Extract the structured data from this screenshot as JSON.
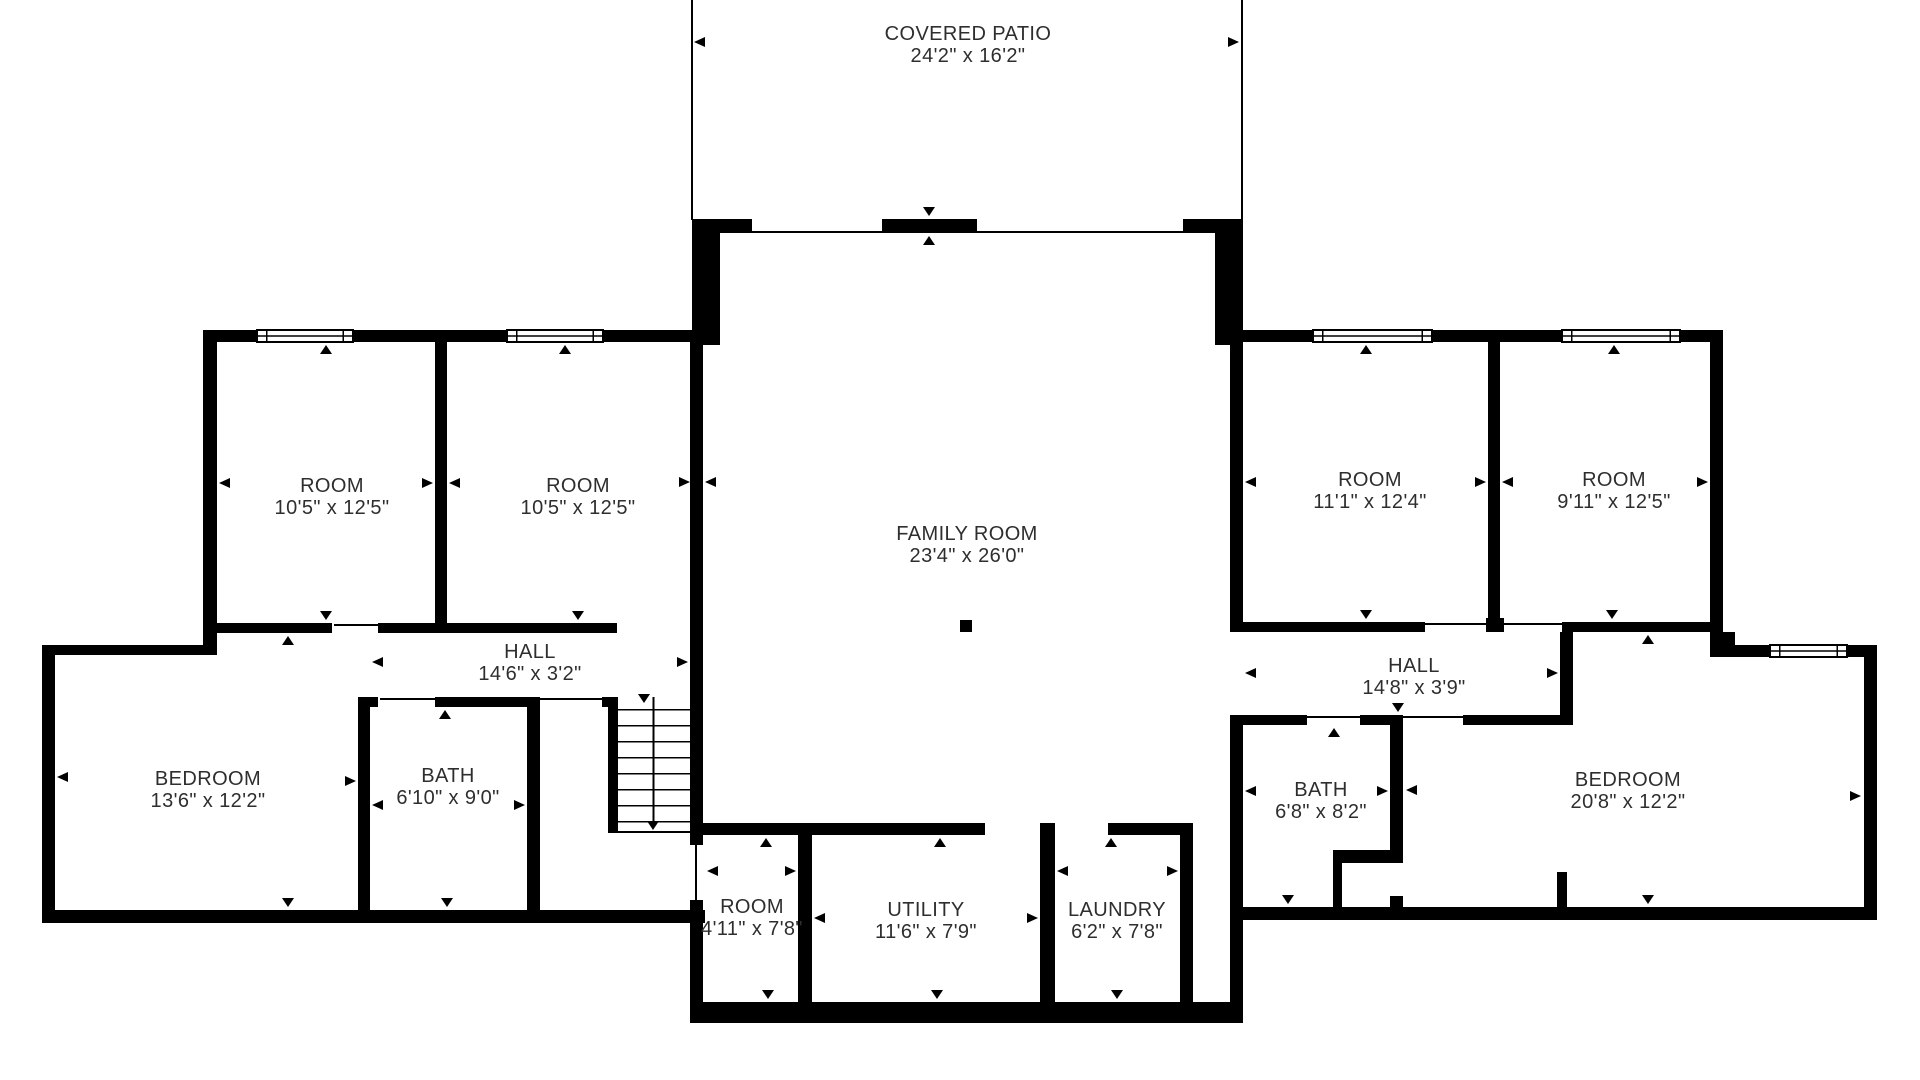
{
  "plan": {
    "type": "floor-plan",
    "colors": {
      "wall": "#000000",
      "text": "#2e2e2e",
      "background": "#ffffff"
    },
    "rooms": [
      {
        "id": "covered-patio",
        "name": "COVERED PATIO",
        "dims": "24'2\" x 16'2\"",
        "cx": 968,
        "cy": 45
      },
      {
        "id": "room-left-1",
        "name": "ROOM",
        "dims": "10'5\" x 12'5\"",
        "cx": 332,
        "cy": 497
      },
      {
        "id": "room-left-2",
        "name": "ROOM",
        "dims": "10'5\" x 12'5\"",
        "cx": 578,
        "cy": 497
      },
      {
        "id": "family-room",
        "name": "FAMILY ROOM",
        "dims": "23'4\" x 26'0\"",
        "cx": 967,
        "cy": 545
      },
      {
        "id": "room-right-1",
        "name": "ROOM",
        "dims": "11'1\" x 12'4\"",
        "cx": 1370,
        "cy": 491
      },
      {
        "id": "room-right-2",
        "name": "ROOM",
        "dims": "9'11\" x 12'5\"",
        "cx": 1614,
        "cy": 491
      },
      {
        "id": "hall-left",
        "name": "HALL",
        "dims": "14'6\" x 3'2\"",
        "cx": 530,
        "cy": 663
      },
      {
        "id": "hall-right",
        "name": "HALL",
        "dims": "14'8\" x 3'9\"",
        "cx": 1414,
        "cy": 677
      },
      {
        "id": "bedroom-left",
        "name": "BEDROOM",
        "dims": "13'6\" x 12'2\"",
        "cx": 208,
        "cy": 790
      },
      {
        "id": "bath-left",
        "name": "BATH",
        "dims": "6'10\" x 9'0\"",
        "cx": 448,
        "cy": 787
      },
      {
        "id": "bath-right",
        "name": "BATH",
        "dims": "6'8\" x 8'2\"",
        "cx": 1321,
        "cy": 801
      },
      {
        "id": "bedroom-right",
        "name": "BEDROOM",
        "dims": "20'8\" x 12'2\"",
        "cx": 1628,
        "cy": 791
      },
      {
        "id": "room-small",
        "name": "ROOM",
        "dims": "4'11\" x 7'8\"",
        "cx": 752,
        "cy": 918
      },
      {
        "id": "utility",
        "name": "UTILITY",
        "dims": "11'6\" x 7'9\"",
        "cx": 926,
        "cy": 921
      },
      {
        "id": "laundry",
        "name": "LAUNDRY",
        "dims": "6'2\" x 7'8\"",
        "cx": 1117,
        "cy": 921
      }
    ]
  }
}
